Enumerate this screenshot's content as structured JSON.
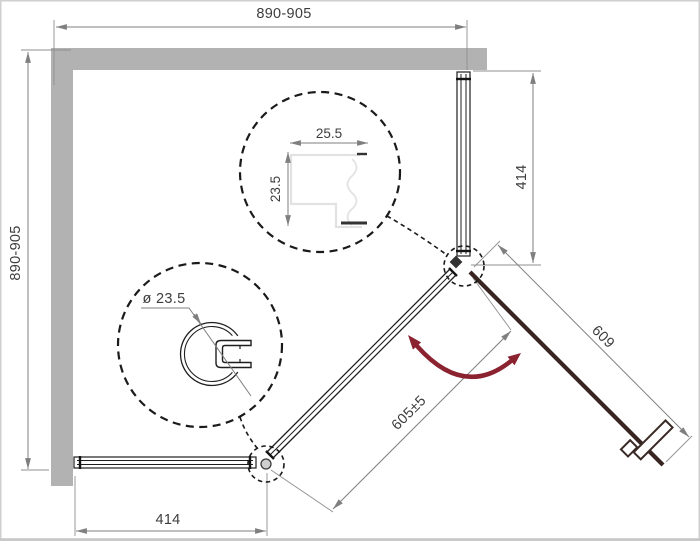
{
  "drawing": {
    "title": "pentagonal-shower-enclosure-plan",
    "dims": {
      "top_width": "890-905",
      "left_depth": "890-905",
      "right_fixed_panel": "414",
      "bottom_fixed_panel": "414",
      "door_length": "609",
      "entry_opening": "605±5"
    },
    "details": {
      "clamp_profile_width": "25.5",
      "clamp_profile_height": "23.5",
      "round_profile_diameter": "ø 23.5"
    },
    "colors": {
      "wall": "#b2b2b2",
      "dimension_line": "#7f7f7f",
      "dimension_text": "#3d3d3d",
      "outline": "#1f1f1f",
      "door": "#382521",
      "swing_arrow": "#8b2230",
      "profile_light": "#e2e2e2",
      "frame_border": "#cccccc"
    }
  }
}
